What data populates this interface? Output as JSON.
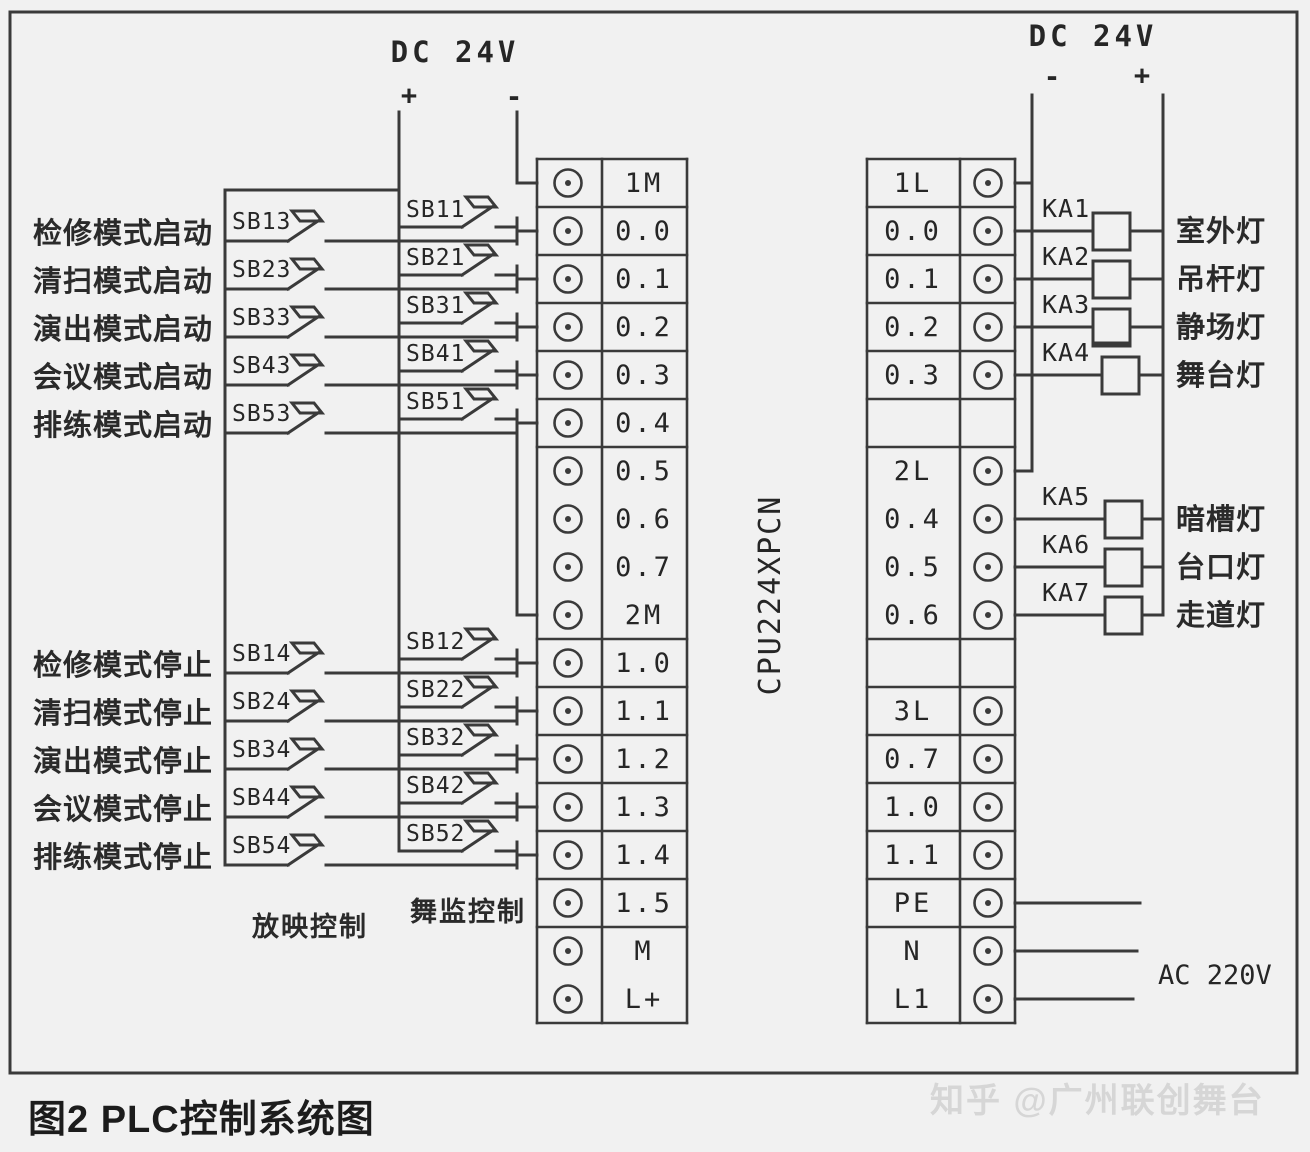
{
  "figure": {
    "caption": "图2 PLC控制系统图",
    "watermark": "知乎 @广州联创舞台"
  },
  "power_left": {
    "title": "DC 24V",
    "plus": "+",
    "minus": "-"
  },
  "power_right": {
    "title": "DC 24V",
    "minus": "-",
    "plus": "+"
  },
  "cpu_label": "CPU224XPCN",
  "ac_label": "AC 220V",
  "control_captions": [
    "放映控制",
    "舞监控制"
  ],
  "left_terminals": [
    "1M",
    "0.0",
    "0.1",
    "0.2",
    "0.3",
    "0.4",
    "0.5",
    "0.6",
    "0.7",
    "2M",
    "1.0",
    "1.1",
    "1.2",
    "1.3",
    "1.4",
    "1.5",
    "M",
    "L+"
  ],
  "right_terminals": [
    "1L",
    "0.0",
    "0.1",
    "0.2",
    "0.3",
    "",
    "2L",
    "0.4",
    "0.5",
    "0.6",
    "",
    "3L",
    "0.7",
    "1.0",
    "1.1",
    "PE",
    "N",
    "L1"
  ],
  "start_inputs": [
    {
      "label": "检修模式启动",
      "outer_button": "SB13",
      "inner_button": "SB11",
      "terminal": "0.0"
    },
    {
      "label": "清扫模式启动",
      "outer_button": "SB23",
      "inner_button": "SB21",
      "terminal": "0.1"
    },
    {
      "label": "演出模式启动",
      "outer_button": "SB33",
      "inner_button": "SB31",
      "terminal": "0.2"
    },
    {
      "label": "会议模式启动",
      "outer_button": "SB43",
      "inner_button": "SB41",
      "terminal": "0.3"
    },
    {
      "label": "排练模式启动",
      "outer_button": "SB53",
      "inner_button": "SB51",
      "terminal": "0.4"
    }
  ],
  "stop_inputs": [
    {
      "label": "检修模式停止",
      "outer_button": "SB14",
      "inner_button": "SB12",
      "terminal": "1.0"
    },
    {
      "label": "清扫模式停止",
      "outer_button": "SB24",
      "inner_button": "SB22",
      "terminal": "1.1"
    },
    {
      "label": "演出模式停止",
      "outer_button": "SB34",
      "inner_button": "SB32",
      "terminal": "1.2"
    },
    {
      "label": "会议模式停止",
      "outer_button": "SB44",
      "inner_button": "SB42",
      "terminal": "1.3"
    },
    {
      "label": "排练模式停止",
      "outer_button": "SB54",
      "inner_button": "SB52",
      "terminal": "1.4"
    }
  ],
  "outputs": [
    {
      "relay": "KA1",
      "lamp": "室外灯",
      "terminal": "0.0"
    },
    {
      "relay": "KA2",
      "lamp": "吊杆灯",
      "terminal": "0.1"
    },
    {
      "relay": "KA3",
      "lamp": "静场灯",
      "terminal": "0.2"
    },
    {
      "relay": "KA4",
      "lamp": "舞台灯",
      "terminal": "0.3"
    },
    {
      "relay": "KA5",
      "lamp": "暗槽灯",
      "terminal": "0.4"
    },
    {
      "relay": "KA6",
      "lamp": "台口灯",
      "terminal": "0.5"
    },
    {
      "relay": "KA7",
      "lamp": "走道灯",
      "terminal": "0.6"
    }
  ]
}
